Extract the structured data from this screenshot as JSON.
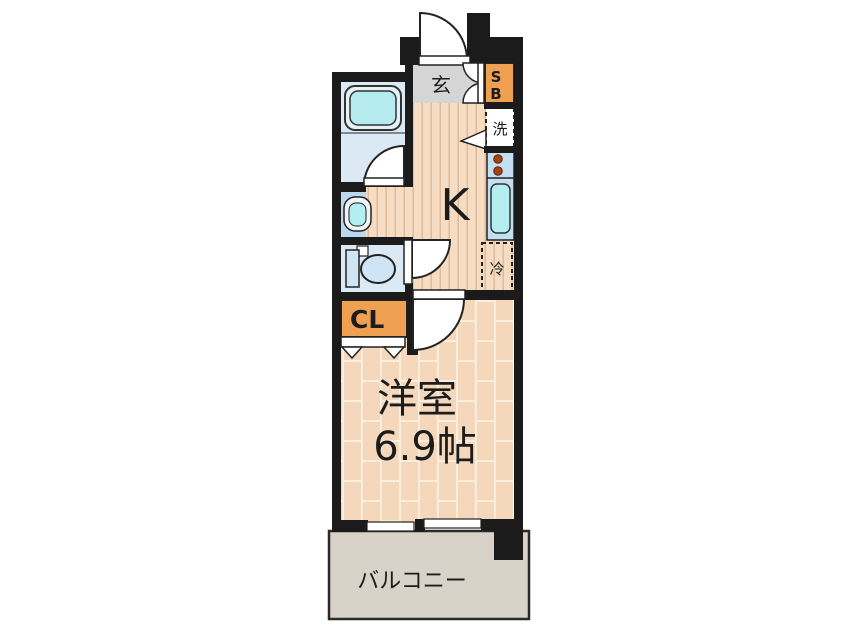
{
  "floorplan": {
    "labels": {
      "entrance": "玄",
      "shoe_box_line1": "S",
      "shoe_box_line2": "B",
      "washer": "洗",
      "kitchen": "K",
      "fridge": "冷",
      "closet": "CL",
      "room_name": "洋室",
      "room_size": "6.9帖",
      "balcony": "バルコニー"
    },
    "colors": {
      "wall": "#1b1b1b",
      "accent_orange": "#f0a052",
      "wood_floor": "#f5dcc2",
      "wood_stripe": "#e0bd98",
      "room_floor": "#f5d8bc",
      "room_grout": "#faeedd",
      "bathroom_blue": "#dbe9f4",
      "fixture_blue": "#c5dff2",
      "tub_cyan": "#b5ebee",
      "sink_cyan": "#b4eef0",
      "genkan_gray": "#d5d5d5",
      "balcony_gray": "#d8d2c9",
      "burner_red": "#a34514",
      "closet_text": "#ffffff"
    }
  }
}
